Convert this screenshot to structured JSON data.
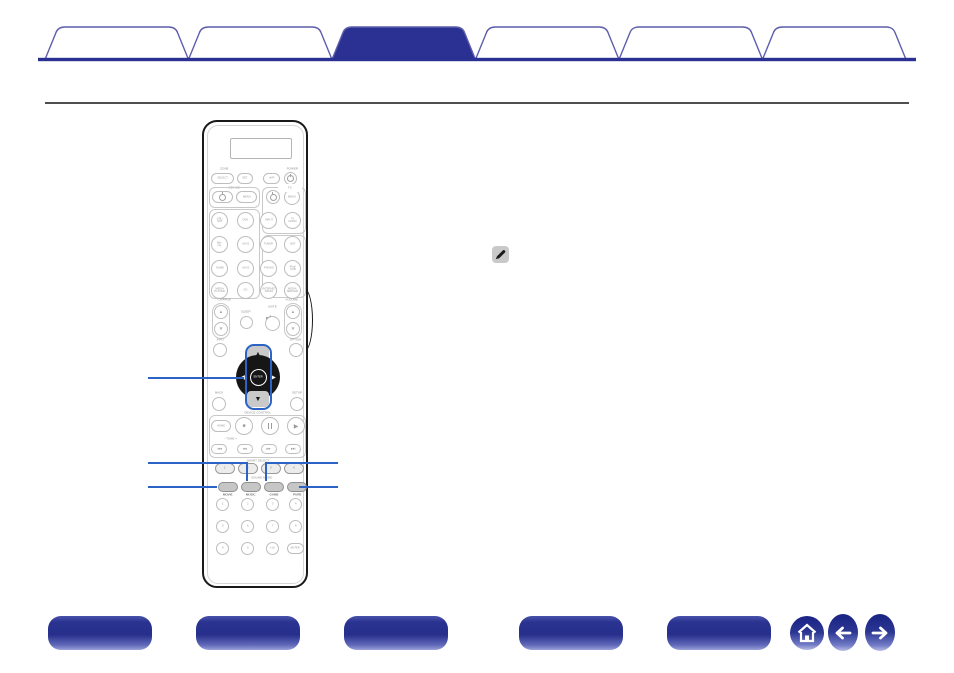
{
  "tabs": {
    "items": [
      {
        "label": "",
        "state": "inactive"
      },
      {
        "label": "",
        "state": "inactive"
      },
      {
        "label": "",
        "state": "active"
      },
      {
        "label": "",
        "state": "inactive"
      },
      {
        "label": "",
        "state": "inactive"
      },
      {
        "label": "",
        "state": "inactive"
      }
    ],
    "outline_color": "#5d5dac",
    "active_fill": "#2b3192",
    "baseline_color": "#2b3192"
  },
  "divider_color": "#4e4e4e",
  "callout_color": "#2b63c6",
  "note": {
    "icon": "pencil-icon",
    "bg": "#c9c9c9"
  },
  "remote": {
    "labels": {
      "zone": "ZONE",
      "power": "POWER",
      "device": "DEVICE",
      "tv": "TV",
      "ch_page": "CH/PAGE",
      "volume": "VOLUME",
      "sleep": "SLEEP",
      "mute": "MUTE",
      "info": "INFO",
      "option": "OPTION",
      "back": "BACK",
      "setup": "SETUP",
      "device_control": "DEVICE CONTROL",
      "tune": "−  TUNE  +",
      "smart_select": "SMART SELECT",
      "sound_mode": "SOUND MODE"
    },
    "buttons": {
      "select": "SELECT",
      "set": "SET",
      "avp": "AVP",
      "device_menu": "MENU",
      "tv_menu": "MENU",
      "enter": "ENTER",
      "home": "HOME",
      "stop": "■",
      "play": "▶",
      "cursor_up": "▲",
      "cursor_down": "▼",
      "cursor_left": "◀",
      "cursor_right": "▶",
      "ch_up": "▲",
      "ch_down": "▼",
      "vol_up": "▲",
      "vol_down": "▼",
      "skip": [
        "|◀◀",
        "◀◀",
        "▶▶",
        "▶▶|"
      ]
    },
    "sources": [
      "CBL/\nSAT",
      "DVD",
      "INPUT",
      "TV\nAUDIO",
      "Blu-ray",
      "AUX1",
      "TUNER",
      "NET",
      "GAME",
      "AUX2",
      "PHONO",
      "iPod/\nUSB",
      "MEDIA\nPLAYER",
      "CD",
      "INTERNET\nRADIO",
      "MEDIA\nSERVER"
    ],
    "smart_select_keys": [
      "1",
      "2",
      "3",
      "4"
    ],
    "sound_modes": [
      "MOVIE",
      "MUSIC",
      "GAME",
      "PURE"
    ],
    "digits": [
      "1",
      "2",
      "3",
      "4",
      "5",
      "6",
      "7",
      "8",
      "9",
      "0",
      "+10",
      "ENTER"
    ]
  },
  "footer": {
    "buttons": [
      {
        "label": ""
      },
      {
        "label": ""
      },
      {
        "label": ""
      },
      {
        "label": ""
      },
      {
        "label": ""
      }
    ],
    "nav_color": "#2b3592"
  }
}
